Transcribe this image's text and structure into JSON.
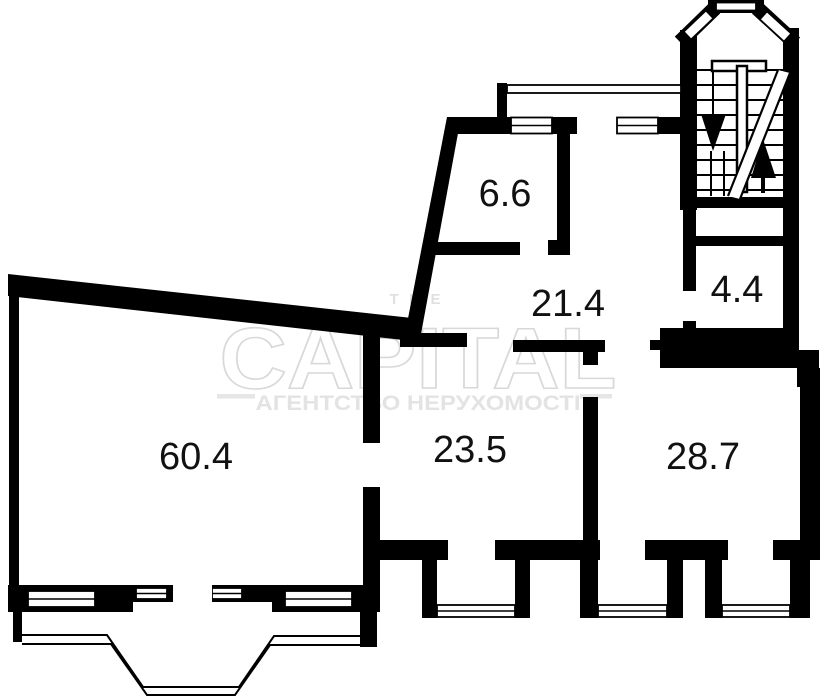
{
  "plan_title": "apartment-floor-plan",
  "rooms": [
    {
      "name": "room-6-6",
      "area": "6.6"
    },
    {
      "name": "room-21-4",
      "area": "21.4"
    },
    {
      "name": "room-4-4",
      "area": "4.4"
    },
    {
      "name": "room-60-4",
      "area": "60.4"
    },
    {
      "name": "room-23-5",
      "area": "23.5"
    },
    {
      "name": "room-28-7",
      "area": "28.7"
    }
  ],
  "watermark": {
    "line_top": "THE",
    "brand": "CAPITAL",
    "line_bottom": "АГЕНТСТВО НЕРУХОМОСТІ"
  },
  "colors": {
    "wall": "#000000",
    "background": "#ffffff",
    "watermark_outline": "#d8d8d8",
    "watermark_text": "#e3e3e3",
    "label_text": "#111111"
  }
}
